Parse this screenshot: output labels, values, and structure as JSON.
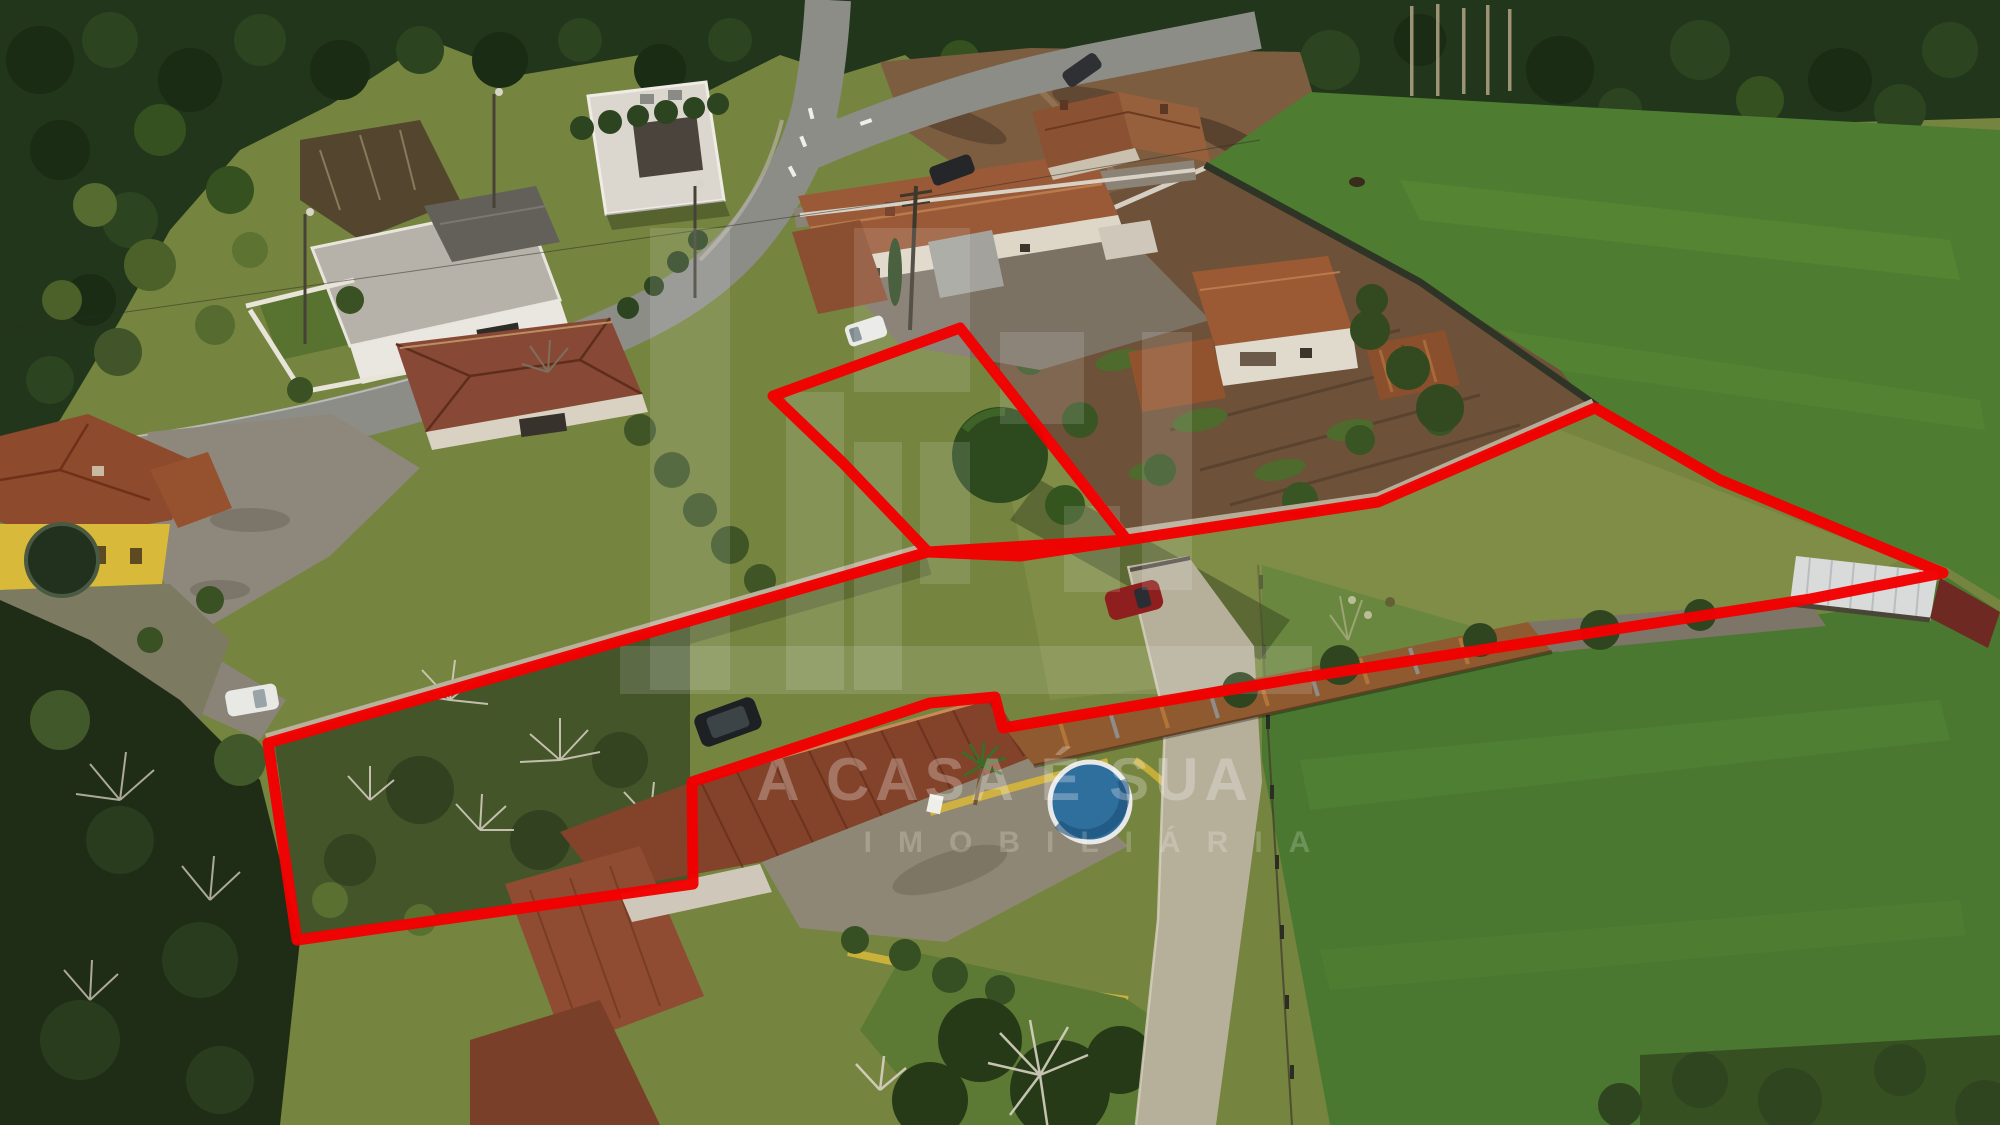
{
  "watermark": {
    "line1": "A CASA É SUA",
    "line2": "IMOBILIÁRIA",
    "line1_color": "rgba(255,255,255,0.27)",
    "line2_color": "rgba(255,255,255,0.20)",
    "block_color": "rgba(255,255,255,0.13)"
  },
  "annotation": {
    "color": "#f20000",
    "stroke_width": 11,
    "parcel_main_points": [
      [
        268,
        743
      ],
      [
        928,
        552
      ],
      [
        1020,
        556
      ],
      [
        1127,
        540
      ],
      [
        1378,
        502
      ],
      [
        1595,
        408
      ],
      [
        1720,
        480
      ],
      [
        1943,
        573
      ],
      [
        1810,
        599
      ],
      [
        1300,
        678
      ],
      [
        1110,
        710
      ],
      [
        1003,
        728
      ],
      [
        995,
        697
      ],
      [
        930,
        703
      ],
      [
        692,
        782
      ],
      [
        693,
        884
      ],
      [
        297,
        940
      ]
    ],
    "parcel_upper_points": [
      [
        773,
        396
      ],
      [
        960,
        328
      ],
      [
        1127,
        540
      ],
      [
        928,
        552
      ],
      [
        843,
        463
      ]
    ]
  },
  "scene": {
    "type": "aerial-drone-photo",
    "palette": {
      "forest": "#22361c",
      "meadow": "#75843f",
      "pasture": "#4e7c31",
      "soil": "#6d5138",
      "road": "#8d8d88",
      "tile_roof": "#83422a",
      "modern_roof": "#b6b2a9",
      "yellow_house": "#d8b93a",
      "pool_water": "#2f6f9e",
      "driveway": "#b6af9a"
    }
  }
}
